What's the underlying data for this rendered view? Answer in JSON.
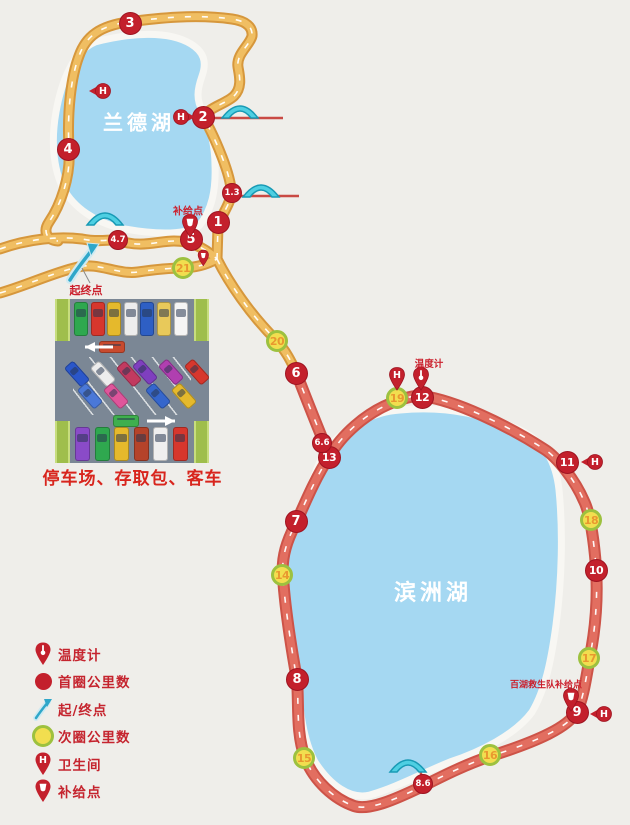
{
  "colors": {
    "background": "#EFEEEA",
    "lake": "#A5D8F2",
    "route_first_half": "#E8A743",
    "route_second_half": "#DD6154",
    "marker_red": "#C3202C",
    "marker_yellow_fill": "#F2DE4F",
    "marker_yellow_ring": "#9DC13F",
    "bridge": "#4ECFE2",
    "label_red": "#CB1F2C"
  },
  "icons": {
    "restroom_glyph": "H"
  },
  "lakes": [
    {
      "name": "兰德湖",
      "x": 139,
      "y": 121,
      "size": 20
    },
    {
      "name": "滨洲湖",
      "x": 433,
      "y": 591,
      "size": 22
    }
  ],
  "map": {
    "first_lap": [
      {
        "n": "1",
        "x": 218,
        "y": 222
      },
      {
        "n": "2",
        "x": 203,
        "y": 117
      },
      {
        "n": "3",
        "x": 130,
        "y": 23
      },
      {
        "n": "4",
        "x": 68,
        "y": 149
      },
      {
        "n": "5",
        "x": 191,
        "y": 239
      },
      {
        "n": "6",
        "x": 296,
        "y": 373
      },
      {
        "n": "7",
        "x": 296,
        "y": 521
      },
      {
        "n": "8",
        "x": 297,
        "y": 679
      },
      {
        "n": "9",
        "x": 577,
        "y": 712
      },
      {
        "n": "10",
        "x": 596,
        "y": 570
      },
      {
        "n": "11",
        "x": 567,
        "y": 462
      },
      {
        "n": "12",
        "x": 422,
        "y": 397
      },
      {
        "n": "13",
        "x": 329,
        "y": 457
      }
    ],
    "second_lap": [
      {
        "n": "14",
        "x": 282,
        "y": 575
      },
      {
        "n": "15",
        "x": 304,
        "y": 758
      },
      {
        "n": "16",
        "x": 490,
        "y": 755
      },
      {
        "n": "17",
        "x": 589,
        "y": 658
      },
      {
        "n": "18",
        "x": 591,
        "y": 520
      },
      {
        "n": "19",
        "x": 397,
        "y": 398
      },
      {
        "n": "20",
        "x": 277,
        "y": 341
      },
      {
        "n": "21",
        "x": 183,
        "y": 268
      }
    ],
    "distance": [
      {
        "n": "1.3",
        "x": 232,
        "y": 193
      },
      {
        "n": "4.7",
        "x": 118,
        "y": 240
      },
      {
        "n": "6.6",
        "x": 322,
        "y": 443
      },
      {
        "n": "8.6",
        "x": 423,
        "y": 784
      }
    ],
    "restroom_pins": [
      {
        "x": 99,
        "y": 91,
        "dir": "left"
      },
      {
        "x": 185,
        "y": 117,
        "dir": "right"
      },
      {
        "x": 397,
        "y": 377,
        "dir": "down"
      },
      {
        "x": 591,
        "y": 462,
        "dir": "left"
      },
      {
        "x": 600,
        "y": 714,
        "dir": "left"
      }
    ],
    "supply_pins": [
      {
        "x": 190,
        "y": 224,
        "scale": 1
      },
      {
        "x": 204,
        "y": 257,
        "scale": 0.7
      },
      {
        "x": 571,
        "y": 698,
        "scale": 1
      }
    ],
    "thermometer_pins": [
      {
        "x": 421,
        "y": 377
      }
    ],
    "labels": [
      {
        "text": "补给点",
        "x": 188,
        "y": 210,
        "size": 10
      },
      {
        "text": "温度计",
        "x": 429,
        "y": 363,
        "size": 9.5
      },
      {
        "text": "百湖救生队补给点",
        "x": 546,
        "y": 684,
        "size": 9
      },
      {
        "text": "起终点",
        "x": 86,
        "y": 290,
        "size": 11
      }
    ]
  },
  "legend": {
    "items": [
      {
        "icon": "thermometer-pin",
        "label": "温度计"
      },
      {
        "icon": "red-circle",
        "label": "首圈公里数"
      },
      {
        "icon": "start-arrow",
        "label": "起/终点"
      },
      {
        "icon": "yellow-circle",
        "label": "次圈公里数"
      },
      {
        "icon": "restroom-pin",
        "label": "卫生间"
      },
      {
        "icon": "supply-pin",
        "label": "补给点"
      }
    ]
  },
  "parking": {
    "caption": "停车场、存取包、客车",
    "top_row": [
      "#2FA84F",
      "#D7372D",
      "#E5B92C",
      "#EDEDED",
      "#2E5FC4",
      "#E8C95A",
      "#F5F5F5"
    ],
    "bottom_row": [
      "#8A4BC8",
      "#2FA84F",
      "#E5B92C",
      "#B5432A",
      "#EFEFEF",
      "#D7372D"
    ],
    "diag_left": [
      "#2B57C9",
      "#4A78D8",
      "#EDEDED",
      "#E0559B",
      "#C23A60"
    ],
    "diag_right": [
      "#7F3FBF",
      "#3566CC",
      "#B03FB0",
      "#E5B92C",
      "#D7372D"
    ],
    "moving_top_car": "#C84A2E",
    "moving_bottom_car": "#3FAF4E"
  }
}
